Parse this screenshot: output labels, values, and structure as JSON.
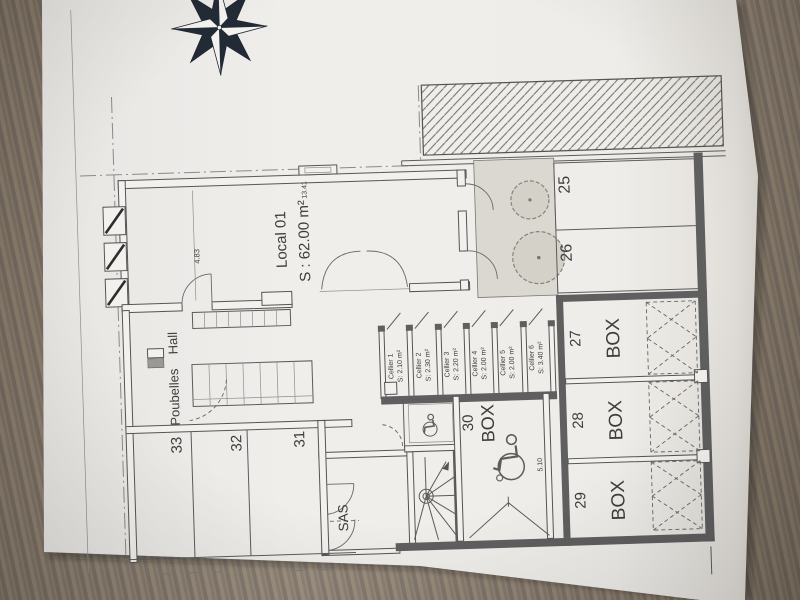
{
  "plan": {
    "local": {
      "name": "Local 01",
      "area": "S : 62.00 m²",
      "dim_h": "4.83",
      "dim_w": "13.41"
    },
    "hall": {
      "poubelles": "Poubelles",
      "hall": "Hall"
    },
    "sas": {
      "label": "SAS"
    },
    "celliers": [
      {
        "name": "Cellier 1",
        "area": "S: 2.10 m²"
      },
      {
        "name": "Cellier 2",
        "area": "S: 2.30 m²"
      },
      {
        "name": "Cellier 3",
        "area": "S: 2.20 m²"
      },
      {
        "name": "Cellier 4",
        "area": "S: 2.00 m²"
      },
      {
        "name": "Cellier 5",
        "area": "S: 2.00 m²"
      },
      {
        "name": "Cellier 6",
        "area": "S: 3.40 m²"
      }
    ],
    "parking_right": [
      {
        "number": "25"
      },
      {
        "number": "26"
      }
    ],
    "boxes": [
      {
        "number": "27",
        "label": "BOX"
      },
      {
        "number": "28",
        "label": "BOX"
      },
      {
        "number": "29",
        "label": "BOX"
      },
      {
        "number": "30",
        "label": "BOX",
        "dim": "5.10"
      }
    ],
    "parking_left": [
      {
        "number": "33"
      },
      {
        "number": "32"
      },
      {
        "number": "31"
      }
    ],
    "icons": {
      "north": "compass-rose-icon",
      "accessible": "wheelchair-icon",
      "vegetation": "tree-icon",
      "stairs": "spiral-staircase-icon"
    },
    "colors": {
      "paper": "#eeece9",
      "wood": "#8c7f6f",
      "ink": "#4a4a4a",
      "courtyard": "#dbd8d2",
      "compass": "#222b35"
    }
  }
}
